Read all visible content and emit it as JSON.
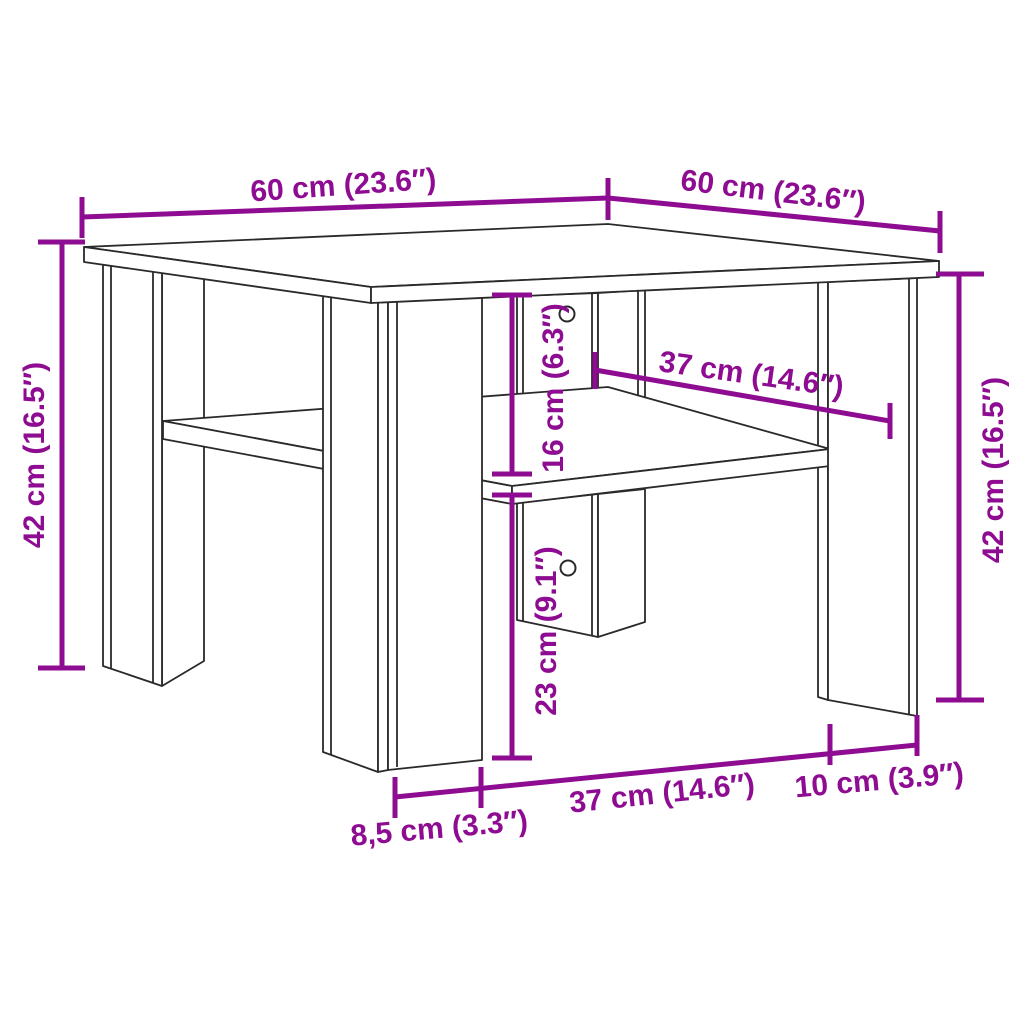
{
  "diagram": {
    "type": "furniture-dimension-diagram",
    "subject": "square coffee table with lower shelf",
    "background_color": "#ffffff",
    "line_color": "#2a2a2a",
    "accent_color": "#8e0c91",
    "dimensions": [
      {
        "id": "top-width-left",
        "label": "60 cm (23.6″)",
        "cm": "60",
        "inch": "23.6"
      },
      {
        "id": "top-depth-right",
        "label": "60 cm (23.6″)",
        "cm": "60",
        "inch": "23.6"
      },
      {
        "id": "height-left",
        "label": "42 cm (16.5″)",
        "cm": "42",
        "inch": "16.5"
      },
      {
        "id": "height-right",
        "label": "42 cm (16.5″)",
        "cm": "42",
        "inch": "16.5"
      },
      {
        "id": "shelf-clearance",
        "label": "16 cm (6.3″)",
        "cm": "16",
        "inch": "6.3"
      },
      {
        "id": "shelf-depth",
        "label": "37 cm (14.6″)",
        "cm": "37",
        "inch": "14.6"
      },
      {
        "id": "under-shelf-height",
        "label": "23 cm (9.1″)",
        "cm": "23",
        "inch": "9.1"
      },
      {
        "id": "leg-inset",
        "label": "8,5 cm (3.3″)",
        "cm": "8,5",
        "inch": "3.3"
      },
      {
        "id": "front-clear-width",
        "label": "37 cm (14.6″)",
        "cm": "37",
        "inch": "14.6"
      },
      {
        "id": "leg-panel-width",
        "label": "10 cm (3.9″)",
        "cm": "10",
        "inch": "3.9"
      }
    ]
  }
}
